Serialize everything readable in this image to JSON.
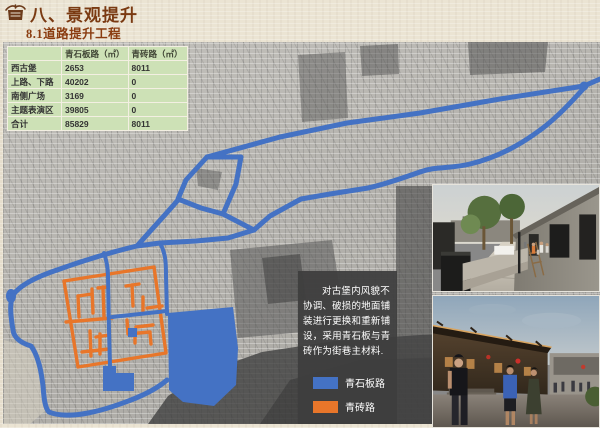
{
  "slide": {
    "title": "八、景观提升",
    "subtitle": "8.1道路提升工程"
  },
  "table": {
    "columns": [
      "",
      "青石板路（㎡）",
      "青砖路（㎡）"
    ],
    "rows": [
      [
        "西古堡",
        "2653",
        "8011"
      ],
      [
        "上路、下路",
        "40202",
        "0"
      ],
      [
        "南侧广场",
        "3169",
        "0"
      ],
      [
        "主题表演区",
        "39805",
        "0"
      ],
      [
        "合计",
        "85829",
        "8011"
      ]
    ]
  },
  "map": {
    "note": "对古堡内风貌不协调、破损的地面铺装进行更换和重新铺设，采用青石板与青砖作为街巷主材料.",
    "legend": [
      {
        "label": "青石板路",
        "color": "#4472c4"
      },
      {
        "label": "青砖路",
        "color": "#e8762a"
      }
    ]
  },
  "photos": [
    {
      "name": "renovated-street-daytime"
    },
    {
      "name": "historic-street-dusk"
    }
  ],
  "colors": {
    "stone_road_blue": "#4472c4",
    "brick_road_orange": "#e8762a",
    "table_green": "#cde1b6",
    "title_brown": "#7a3a12"
  }
}
